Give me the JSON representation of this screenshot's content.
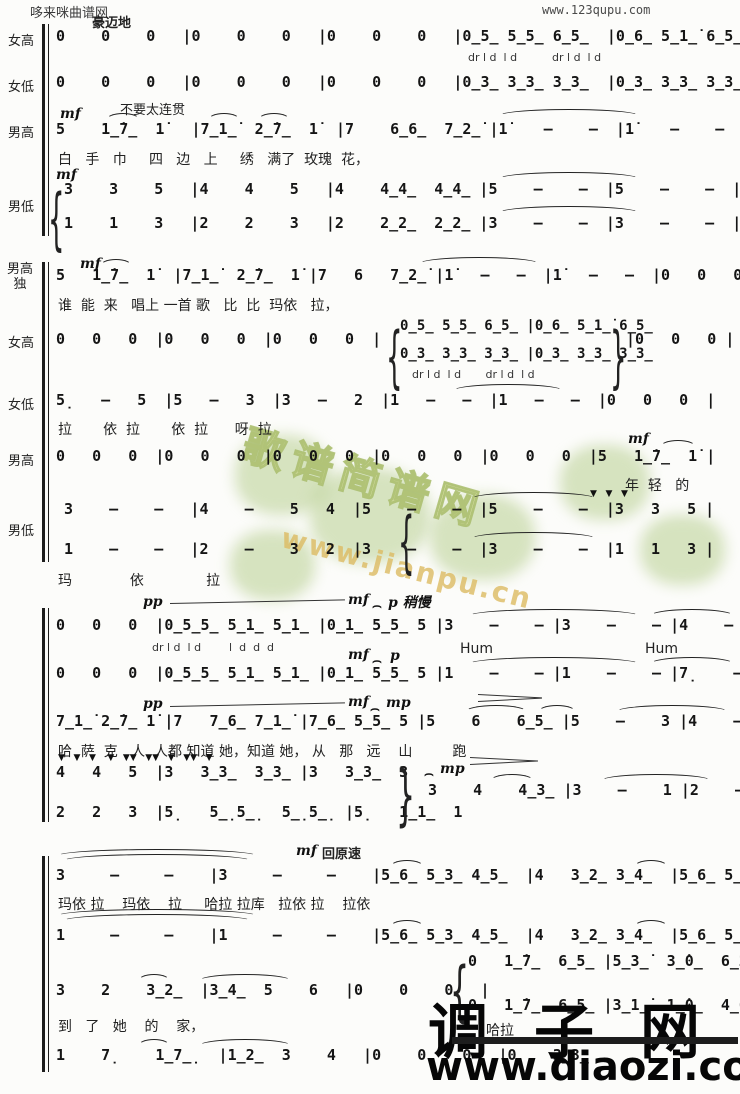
{
  "header": {
    "site_left": "哆来咪曲谱网",
    "site_right": "www.123qupu.com"
  },
  "watermark": {
    "text": "歌谱简谱网",
    "url": "www.jianpu.cn"
  },
  "footer_logo": {
    "name": "调子网",
    "url": "www.diaozi.com"
  },
  "glyphs": {
    "fermata": "⌢",
    "brace_open": "{",
    "brace_close": "}"
  },
  "systems": {
    "s1": {
      "tempo": "豪迈地",
      "sop": {
        "label": "女高",
        "notes": "0    0    0   |0    0    0   |0    0    0   |0̲5̲ 5̲5̲ 6̲5̲  |0̲6̲ 5̲1̲̇ 6̲5̲  |",
        "syllables": "dr l d  l d          dr l d  l d"
      },
      "alto": {
        "label": "女低",
        "notes": "0    0    0   |0    0    0   |0    0    0   |0̲3̲ 3̲3̲ 3̲3̲  |0̲3̲ 3̲3̲ 3̲3̲  |"
      },
      "tenor": {
        "label": "男高",
        "dyn": "mf",
        "annotation": "不要太连贯",
        "notes": "5    1̲̇7̲  1̇   |7̲1̲̇  2̲̇7̲  1̇  |7    6̲6̲  7̲2̲̇ |1̇    –    –  |1̇    –    –  |",
        "lyrics": "白   手   巾     四   边   上     绣   满了  玫瑰  花，"
      },
      "bass": {
        "label": "男低",
        "dyn": "mf",
        "upper": "3    3    5   |4    4    5   |4    4̲4̲  4̲4̲ |5    –    –  |5    –    –  |",
        "lower": "1    1    3   |2    2    3   |2    2̲2̲  2̲2̲ |3    –    –  |3    –    –  |"
      }
    },
    "s2": {
      "solo": {
        "label": "男高独",
        "dyn": "mf",
        "notes": "5   1̲̇7̲  1̇  |7̲1̲̇  2̲̇7̲  1̇ |7   6   7̲2̲̇ |1̇   –   –  |1̇   –   –  |0   0   0  |",
        "lyrics": "谁  能  来   唱上 一首 歌   比  比  玛依   拉，"
      },
      "sop": {
        "label": "女高",
        "rest_pre": "0   0   0  |0   0   0  |0   0   0  |",
        "chord_upper": "0̲5̲ 5̲5̲ 6̲5̲ |0̲6̲ 5̲1̲̇ 6̲5̲",
        "chord_lower": "0̲3̲ 3̲3̲ 3̲3̲ |0̲3̲ 3̲3̲ 3̲3̲",
        "rest_post": "|0   0   0 |",
        "syllables": "dr l d  l d       dr l d  l d"
      },
      "alto": {
        "label": "女低",
        "notes": "5̣   –   5  |5   –   3  |3   –   2  |1   –   –  |1   –   –  |0   0   0  |",
        "lyrics": "拉       依  拉       依  拉      呀  拉"
      },
      "tenor": {
        "label": "男高",
        "dyn": "mf",
        "notes": "0   0   0  |0   0   0  |0   0   0  |0   0   0  |0   0   0  |5   1̲̇7̲  1̇ |",
        "lyrics": "年  轻   的"
      },
      "bass": {
        "label": "男低",
        "accents": "▼   ▼   ▼",
        "upper": "3    –    –   |4    –    5   4  |5    –    –  |5    –    –  |3   3   5 |",
        "lower": "1    –    –   |2    –    3   2  |3    –    –  |3    –    –  |1   1   3 |",
        "lyrics": "玛             依              拉"
      }
    },
    "s3": {
      "sop": {
        "dyn_pp": "pp",
        "dyn_mf": "mf",
        "dyn_slow": "p 稍慢",
        "notes": "0   0   0  |0̲5̲5̲ 5̲1̲ 5̲1̲ |0̲1̲ 5̲5̲ 5 |3    –    – |3    –    – |4    –    – |",
        "syllables": "dr l d  l d        l  d  d  d",
        "hum1": "Hum",
        "hum2": "Hum"
      },
      "alto": {
        "dyn_mf": "mf",
        "dyn_p": "p",
        "notes": "0   0   0  |0̲5̲5̲ 5̲1̲ 5̲1̲ |0̲1̲ 5̲5̲ 5 |1    –    – |1    –    – |7̣    –    – |"
      },
      "tenor": {
        "dyn_pp": "pp",
        "dyn_mf": "mf",
        "dyn_mp": "mp",
        "notes": "7̲1̲̇ 2̲̇7̲ 1̇ |7   7̲6̲ 7̲1̲̇ |7̲6̲ 5̲5̲ 5 |5    6    6̲5̲ |5    –    3 |4    –    5̲4̲ |",
        "lyrics": "哈  萨  克   人  人都 知道 她，知道 她， 从   那   远    山         跑"
      },
      "bass": {
        "accents": "▼   ▼   ▼    ▼   ▼▼   ▼▼   ▼   ▼▼   ▼",
        "upper": "4   4   5  |3   3̲3̲  3̲3̲ |3   3̲3̲  3",
        "lower": "2   2   3  |5̣   5̲̣5̲̣  5̲̣5̲̣ |5̣   1̲1̲  1",
        "dyn_mp": "mp",
        "merged": "3    4    4̲3̲ |3    –    1 |2    –    3̲2̲ |"
      }
    },
    "s4": {
      "tempo_dyn": "mf",
      "tempo_text": "回原速",
      "sop": {
        "notes": "3     –     –    |3     –     –    |5̲6̲ 5̲3̲ 4̲5̲  |4   3̲2̲ 3̲4̲  |5̲6̲ 5̲3̲ 4̲5̲  |",
        "lyrics": "玛依 拉    玛依    拉     哈拉 拉库   拉依 拉    拉依"
      },
      "alto": {
        "notes": "1     –     –    |1     –     –    |5̲6̲ 5̲3̲ 4̲5̲  |4   3̲2̲ 3̲4̲  |5̲6̲ 5̲3̲ 4̲5̲  |"
      },
      "tenor": {
        "notes_left": "3    2    3̲2̲  |3̲4̲  5    6   |0    0    0   |",
        "chord_upper": "0   1̲̇7̲  6̲5̲ |5̲3̲̇  3̲̇0̲  6̲2̲̇ |",
        "chord_lower": "0   1̲̇7̲  6̲5̲ |3̲1̲̇  1̲̇0̲  4̲6̲ |",
        "lyrics": "到   了   她    的    家，",
        "lyrics_right": "哈拉"
      },
      "bass": {
        "notes": "1    7̣    1̲7̲̣  |1̲2̲  3    4   |0    0    0   |0    3̲3̲"
      }
    }
  }
}
